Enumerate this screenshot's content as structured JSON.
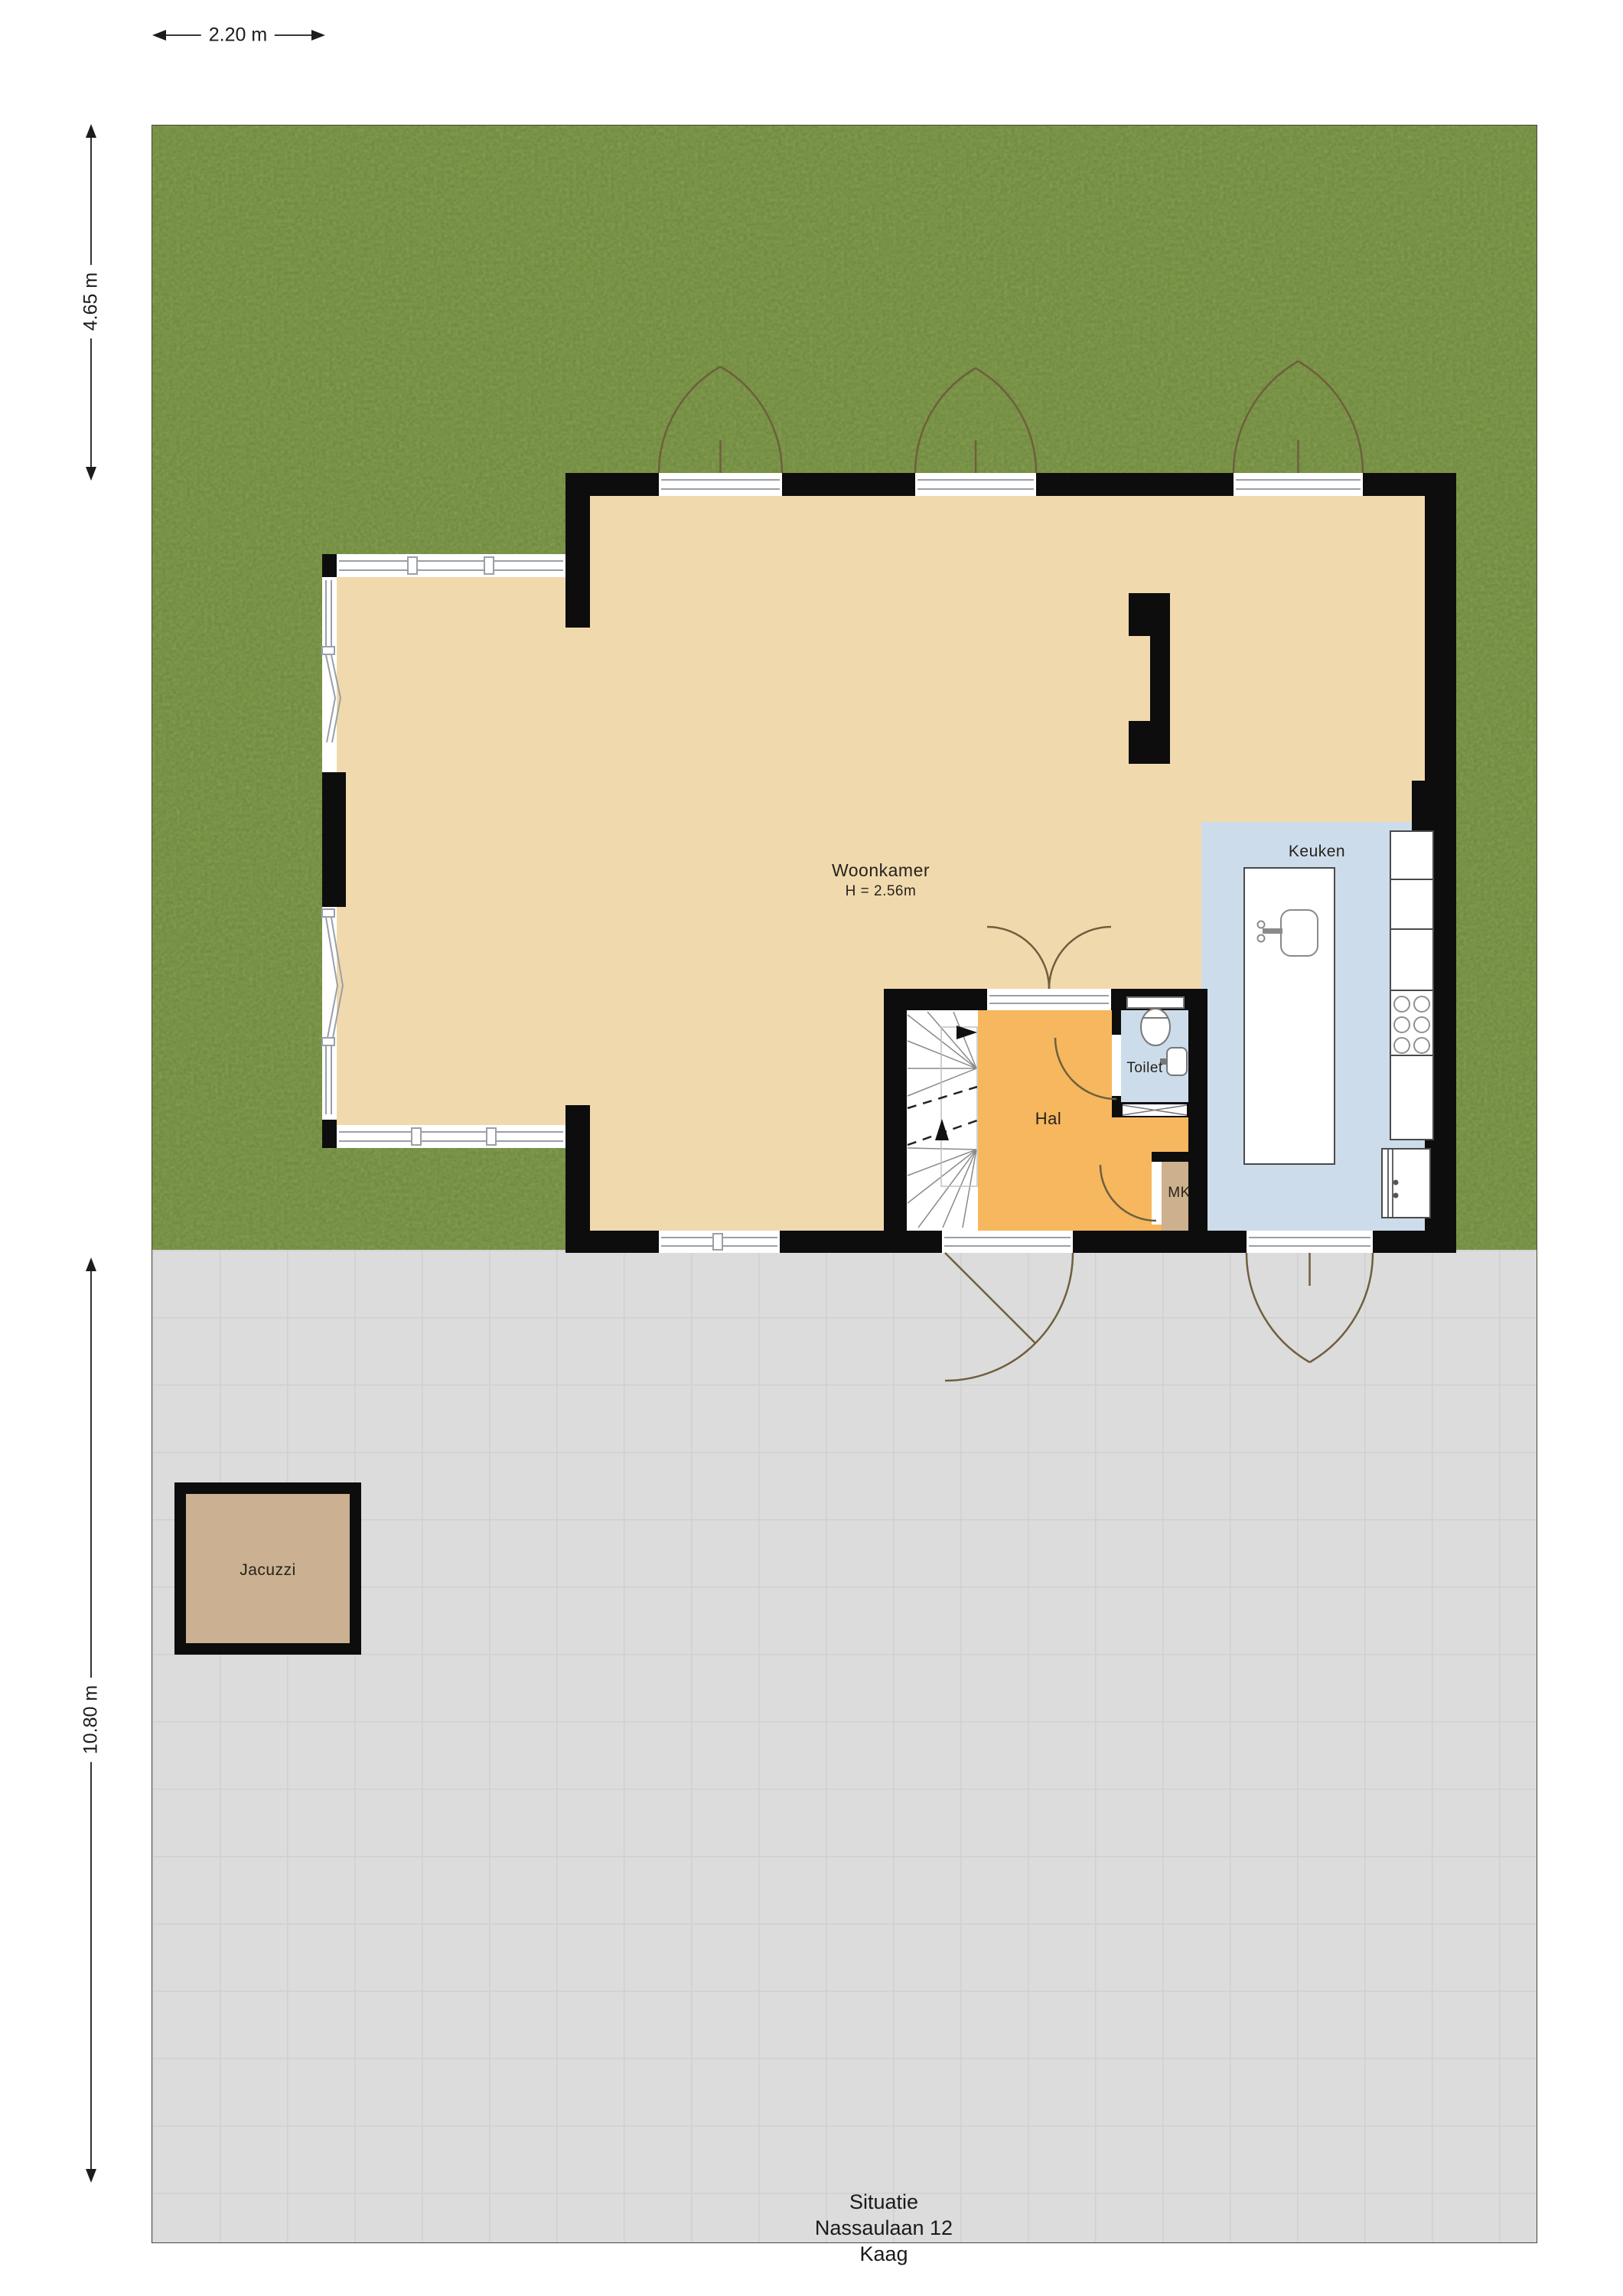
{
  "title": {
    "lines": [
      "Situatie",
      "Nassaulaan 12",
      "Kaag"
    ]
  },
  "dimensions": {
    "top": "2.20 m",
    "left_upper": "4.65 m",
    "left_lower": "10.80 m"
  },
  "rooms": {
    "woonkamer": {
      "label": "Woonkamer",
      "height": "H = 2.56m"
    },
    "keuken": {
      "label": "Keuken"
    },
    "hal": {
      "label": "Hal"
    },
    "toilet": {
      "label": "Toilet"
    },
    "mk": {
      "label": "MK"
    }
  },
  "outdoor": {
    "jacuzzi": {
      "label": "Jacuzzi"
    }
  },
  "colors": {
    "grass": "#6f8c3f",
    "pavement": "#dcdcdc",
    "wall": "#0d0d0d",
    "woonkamer": "#f1d9ae",
    "hal": "#f6b75e",
    "keuken": "#ccdcea",
    "toilet": "#ccdcea",
    "closet": "#cdb08d",
    "jacuzzi": "#cbb191",
    "door_arc": "#6f5f3e"
  }
}
